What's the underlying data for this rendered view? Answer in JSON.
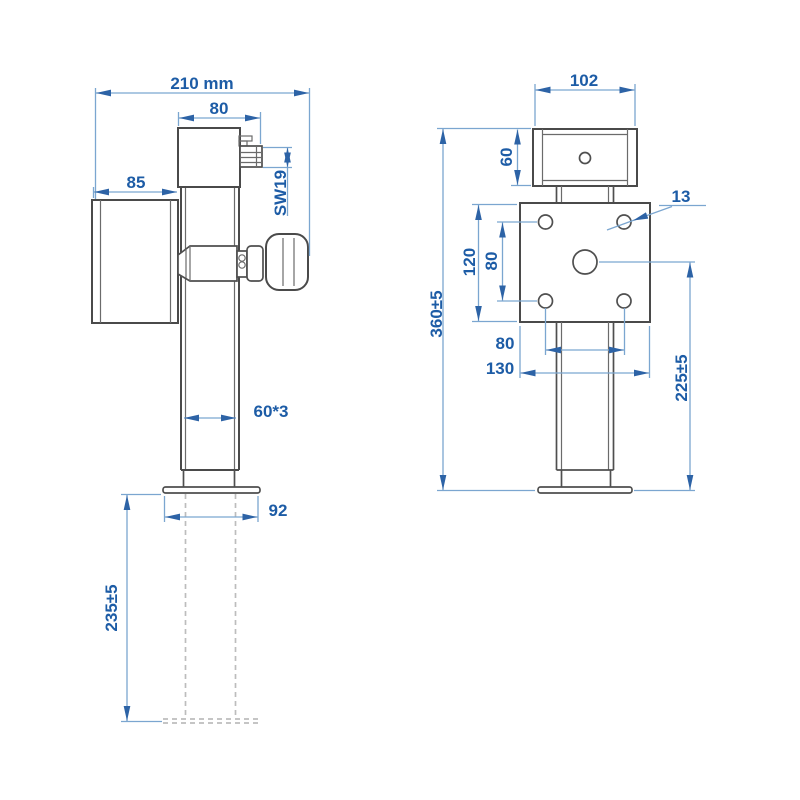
{
  "title": "telescopic drop leg jack technical drawing",
  "colors": {
    "background": "#ffffff",
    "drawing_line": "#4a4a4a",
    "dimension_line": "#7ba6d0",
    "dimension_text": "#1d5ca6",
    "hidden_line": "#bdbdbd"
  },
  "views": {
    "side": {
      "name": "side view",
      "dims": {
        "total_width": "210 mm",
        "gearbox_width": "80",
        "motor_length": "85",
        "crank_hex": "SW19",
        "tube_size": "60*3",
        "foot_width": "92",
        "extension_stroke": "235±5"
      }
    },
    "front": {
      "name": "front view",
      "dims": {
        "gearbox_width": "102",
        "gearbox_height": "60",
        "hole_diameter": "13",
        "plate_height": "120",
        "hole_spacing_vertical": "80",
        "total_height": "360±5",
        "hole_spacing_horizontal": "80",
        "plate_width": "130",
        "center_to_foot": "225±5"
      }
    }
  }
}
